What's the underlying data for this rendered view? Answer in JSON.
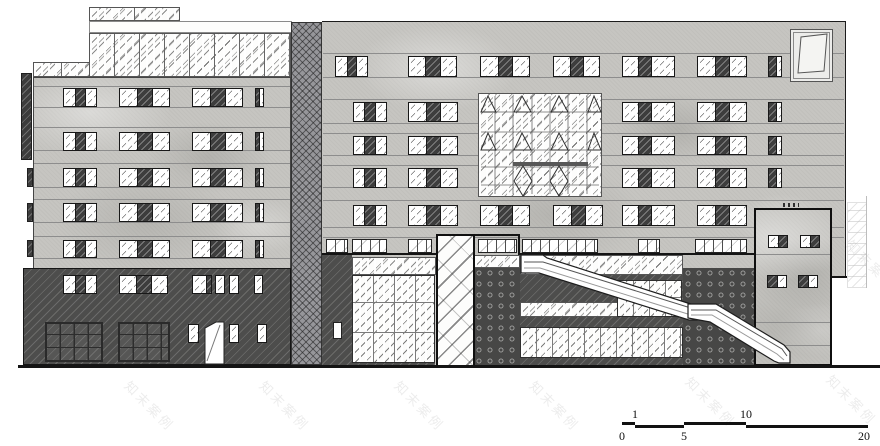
{
  "watermark": {
    "text": "知末案例",
    "positions": [
      [
        118,
        396
      ],
      [
        253,
        396
      ],
      [
        388,
        396
      ],
      [
        523,
        396
      ],
      [
        679,
        392
      ],
      [
        820,
        390
      ],
      [
        115,
        258
      ],
      [
        385,
        258
      ],
      [
        655,
        258
      ],
      [
        840,
        255
      ],
      [
        180,
        122
      ],
      [
        450,
        122
      ],
      [
        720,
        122
      ]
    ]
  },
  "scale_bar": {
    "unit_values": [
      "0",
      "1",
      "5",
      "10",
      "20"
    ],
    "segments": [
      {
        "x": 622,
        "y": 422,
        "w": 13
      },
      {
        "x": 635,
        "y": 425,
        "w": 49
      },
      {
        "x": 684,
        "y": 422,
        "w": 62
      },
      {
        "x": 746,
        "y": 425,
        "w": 122
      }
    ],
    "ticks_above": [
      {
        "label": "1",
        "x": 635
      },
      {
        "label": "10",
        "x": 746
      }
    ],
    "ticks_below": [
      {
        "label": "0",
        "x": 622
      },
      {
        "label": "5",
        "x": 684
      },
      {
        "label": "20",
        "x": 864
      }
    ]
  },
  "drawing": {
    "rects": [
      {
        "n": "left-side-fin",
        "c": "darkfin",
        "x": 21,
        "y": 73,
        "w": 11,
        "h": 87
      },
      {
        "n": "left-slab-tab-1",
        "c": "darkfin",
        "x": 27,
        "y": 168,
        "w": 6,
        "h": 19
      },
      {
        "n": "left-slab-tab-2",
        "c": "darkfin",
        "x": 27,
        "y": 203,
        "w": 6,
        "h": 19
      },
      {
        "n": "left-slab-tab-3",
        "c": "darkfin",
        "x": 27,
        "y": 240,
        "w": 6,
        "h": 17
      },
      {
        "n": "roof-glass-strip",
        "c": "glassband",
        "x": 89,
        "y": 7,
        "w": 91,
        "h": 14,
        "v": {
          "--mull": "45px"
        }
      },
      {
        "n": "roof-white-band",
        "c": "plainband",
        "x": 89,
        "y": 21,
        "w": 203,
        "h": 12
      },
      {
        "n": "upper-glass-band",
        "c": "glassband",
        "x": 89,
        "y": 33,
        "w": 202,
        "h": 44,
        "v": {
          "--mull": "25px"
        }
      },
      {
        "n": "upper-glass-band-left",
        "c": "glassband",
        "x": 33,
        "y": 62,
        "w": 57,
        "h": 15,
        "v": {
          "--mull": "28px"
        }
      },
      {
        "n": "left-facade",
        "c": "concrete edge-all-lt",
        "x": 33,
        "y": 77,
        "w": 258,
        "h": 191
      },
      {
        "n": "floor-line",
        "c": "hline",
        "x": 34,
        "y": 86,
        "w": 256,
        "h": 1
      },
      {
        "n": "floor-line",
        "c": "hline",
        "x": 34,
        "y": 107,
        "w": 256,
        "h": 1
      },
      {
        "n": "floor-line",
        "c": "hline",
        "x": 34,
        "y": 127,
        "w": 256,
        "h": 1
      },
      {
        "n": "floor-line",
        "c": "hline",
        "x": 34,
        "y": 150,
        "w": 256,
        "h": 1
      },
      {
        "n": "floor-line",
        "c": "hline",
        "x": 34,
        "y": 163,
        "w": 256,
        "h": 1
      },
      {
        "n": "floor-line",
        "c": "hline",
        "x": 34,
        "y": 187,
        "w": 256,
        "h": 1
      },
      {
        "n": "floor-line",
        "c": "hline",
        "x": 34,
        "y": 199,
        "w": 256,
        "h": 1
      },
      {
        "n": "floor-line",
        "c": "hline",
        "x": 34,
        "y": 222,
        "w": 256,
        "h": 1
      },
      {
        "n": "floor-line",
        "c": "hline",
        "x": 34,
        "y": 236,
        "w": 256,
        "h": 1
      },
      {
        "n": "floor-line",
        "c": "hline",
        "x": 34,
        "y": 258,
        "w": 256,
        "h": 1
      },
      {
        "n": "left-base-wall",
        "c": "darkwall edge-dark",
        "x": 23,
        "y": 268,
        "w": 268,
        "h": 97
      },
      {
        "n": "storefront-grid-1",
        "c": "storefront",
        "x": 45,
        "y": 322,
        "w": 58,
        "h": 40
      },
      {
        "n": "storefront-grid-2",
        "c": "storefront",
        "x": 118,
        "y": 322,
        "w": 52,
        "h": 40
      },
      {
        "n": "link-tower",
        "c": "crosshatch",
        "x": 291,
        "y": 22,
        "w": 31,
        "h": 343
      },
      {
        "n": "right-facade-upper",
        "c": "concrete edge-top edge-right",
        "x": 322,
        "y": 21,
        "w": 524,
        "h": 256
      },
      {
        "n": "right-facade-lower",
        "c": "concrete",
        "x": 322,
        "y": 277,
        "w": 510,
        "h": 88
      },
      {
        "n": "floor-line",
        "c": "hline",
        "x": 323,
        "y": 53,
        "w": 521,
        "h": 1
      },
      {
        "n": "floor-line",
        "c": "hline",
        "x": 323,
        "y": 77,
        "w": 521,
        "h": 1
      },
      {
        "n": "floor-line",
        "c": "hline",
        "x": 323,
        "y": 99,
        "w": 521,
        "h": 1
      },
      {
        "n": "floor-line",
        "c": "hline",
        "x": 323,
        "y": 123,
        "w": 521,
        "h": 1
      },
      {
        "n": "floor-line",
        "c": "hline",
        "x": 323,
        "y": 133,
        "w": 521,
        "h": 1
      },
      {
        "n": "floor-line",
        "c": "hline",
        "x": 323,
        "y": 155,
        "w": 521,
        "h": 1
      },
      {
        "n": "floor-line",
        "c": "hline",
        "x": 323,
        "y": 165,
        "w": 521,
        "h": 1
      },
      {
        "n": "floor-line",
        "c": "hline",
        "x": 323,
        "y": 187,
        "w": 521,
        "h": 1
      },
      {
        "n": "floor-line",
        "c": "hline",
        "x": 323,
        "y": 200,
        "w": 521,
        "h": 1
      },
      {
        "n": "floor-line",
        "c": "hline",
        "x": 323,
        "y": 227,
        "w": 521,
        "h": 1
      },
      {
        "n": "floor-line",
        "c": "hline",
        "x": 323,
        "y": 237,
        "w": 521,
        "h": 1
      },
      {
        "n": "right-step-line",
        "c": "solidblack",
        "x": 830,
        "y": 276,
        "w": 17,
        "h": 2
      },
      {
        "n": "groundfloor-outline-left",
        "c": "solidblack",
        "x": 322,
        "y": 253,
        "w": 114,
        "h": 2
      },
      {
        "n": "groundfloor-outline-raised",
        "c": "solidblack",
        "x": 436,
        "y": 234,
        "w": 84,
        "h": 2
      },
      {
        "n": "groundfloor-outline-raised-drop",
        "c": "solidblack",
        "x": 518,
        "y": 236,
        "w": 2,
        "h": 19
      },
      {
        "n": "groundfloor-outline-right",
        "c": "solidblack",
        "x": 520,
        "y": 253,
        "w": 238,
        "h": 2
      },
      {
        "n": "clerestory-window",
        "c": "clerestory",
        "x": 326,
        "y": 239,
        "w": 22,
        "h": 14
      },
      {
        "n": "clerestory-window",
        "c": "clerestory",
        "x": 352,
        "y": 239,
        "w": 35,
        "h": 14
      },
      {
        "n": "clerestory-window",
        "c": "clerestory",
        "x": 408,
        "y": 239,
        "w": 24,
        "h": 14
      },
      {
        "n": "clerestory-window",
        "c": "clerestory",
        "x": 478,
        "y": 239,
        "w": 39,
        "h": 14
      },
      {
        "n": "clerestory-window",
        "c": "clerestory",
        "x": 522,
        "y": 239,
        "w": 76,
        "h": 14
      },
      {
        "n": "clerestory-window",
        "c": "clerestory",
        "x": 638,
        "y": 239,
        "w": 22,
        "h": 14
      },
      {
        "n": "clerestory-window",
        "c": "clerestory",
        "x": 695,
        "y": 239,
        "w": 52,
        "h": 14
      },
      {
        "n": "gf-wall-left",
        "c": "darkwall",
        "x": 322,
        "y": 255,
        "w": 30,
        "h": 110
      },
      {
        "n": "gf-small-door",
        "c": "whitedoor",
        "x": 333,
        "y": 322,
        "w": 9,
        "h": 17
      },
      {
        "n": "gf-light-band-1",
        "c": "glassband",
        "x": 352,
        "y": 257,
        "w": 84,
        "h": 18,
        "v": {
          "--mull": "90px"
        }
      },
      {
        "n": "gf-big-glazing",
        "c": "glazing",
        "x": 352,
        "y": 275,
        "w": 83,
        "h": 88,
        "v": {
          "--gx": "21px",
          "--gy": "30px"
        }
      },
      {
        "n": "gf-under-strip-1",
        "c": "darkwall",
        "x": 352,
        "y": 363,
        "w": 83,
        "h": 2
      },
      {
        "n": "gf-light-band-1b",
        "c": "glassband",
        "x": 474,
        "y": 255,
        "w": 46,
        "h": 13,
        "v": {
          "--mull": "95px"
        }
      },
      {
        "n": "gf-dot-panel-1",
        "c": "dotted",
        "x": 474,
        "y": 268,
        "w": 46,
        "h": 97
      },
      {
        "n": "gf-light-band-2",
        "c": "glassband",
        "x": 520,
        "y": 255,
        "w": 163,
        "h": 20,
        "v": {
          "--mull": "180px"
        }
      },
      {
        "n": "gf-dark-band-1",
        "c": "darkwall",
        "x": 520,
        "y": 275,
        "w": 163,
        "h": 27
      },
      {
        "n": "gf-light-band-3",
        "c": "glassband",
        "x": 520,
        "y": 302,
        "w": 163,
        "h": 15,
        "v": {
          "--mull": "180px"
        }
      },
      {
        "n": "gf-dark-band-2",
        "c": "darkwall",
        "x": 520,
        "y": 317,
        "w": 163,
        "h": 10
      },
      {
        "n": "gf-glazing-row",
        "c": "glazing",
        "x": 520,
        "y": 327,
        "w": 163,
        "h": 31,
        "v": {
          "--gx": "16px",
          "--gy": "31px"
        }
      },
      {
        "n": "gf-under-strip-2",
        "c": "darkwall",
        "x": 520,
        "y": 358,
        "w": 163,
        "h": 7
      },
      {
        "n": "gf-glass-block",
        "c": "glazing",
        "x": 617,
        "y": 280,
        "w": 65,
        "h": 37,
        "v": {
          "--gx": "16px",
          "--gy": "19px"
        }
      },
      {
        "n": "gf-dot-panel-2",
        "c": "dotted",
        "x": 683,
        "y": 268,
        "w": 72,
        "h": 97
      },
      {
        "n": "gf-glass-tower",
        "c": "towerglass",
        "x": 436,
        "y": 234,
        "w": 39,
        "h": 131
      },
      {
        "n": "right-annex-faint",
        "c": "annex",
        "x": 847,
        "y": 202,
        "w": 20,
        "h": 86
      },
      {
        "n": "right-annex-line",
        "c": "vline",
        "x": 866,
        "y": 196,
        "w": 1,
        "h": 92
      },
      {
        "n": "entry-box",
        "c": "concrete box-border",
        "x": 754,
        "y": 208,
        "w": 78,
        "h": 158
      },
      {
        "n": "box-floor-line",
        "c": "hline",
        "x": 756,
        "y": 254,
        "w": 74,
        "h": 1
      },
      {
        "n": "box-floor-line",
        "c": "hline",
        "x": 756,
        "y": 322,
        "w": 74,
        "h": 1
      },
      {
        "n": "box-floor-line",
        "c": "hline",
        "x": 756,
        "y": 345,
        "w": 74,
        "h": 1
      },
      {
        "n": "box-vent-ticks",
        "c": "ticks",
        "x": 783,
        "y": 203,
        "w": 16,
        "h": 4
      },
      {
        "n": "roof-detail-panel",
        "c": "detailpanel",
        "x": 790,
        "y": 29,
        "w": 43,
        "h": 53
      },
      {
        "n": "curtainwall-feature-frame",
        "c": "glassband",
        "x": 478,
        "y": 93,
        "w": 124,
        "h": 104,
        "v": {
          "--mull": "300px"
        }
      },
      {
        "n": "ground-line",
        "c": "solidblack",
        "x": 18,
        "y": 365,
        "w": 862,
        "h": 3
      }
    ],
    "windows": [
      {
        "x": 63,
        "y": 88,
        "w": 34,
        "h": 19,
        "p": "g,d,g"
      },
      {
        "x": 119,
        "y": 88,
        "w": 51,
        "h": 19,
        "p": "g,d,g"
      },
      {
        "x": 192,
        "y": 88,
        "w": 51,
        "h": 19,
        "p": "g,d,g"
      },
      {
        "x": 255,
        "y": 88,
        "w": 9,
        "h": 19,
        "p": "d45,g55"
      },
      {
        "x": 63,
        "y": 132,
        "w": 34,
        "h": 19,
        "p": "g,d,g"
      },
      {
        "x": 119,
        "y": 132,
        "w": 51,
        "h": 19,
        "p": "g,d,g"
      },
      {
        "x": 192,
        "y": 132,
        "w": 51,
        "h": 19,
        "p": "g,d,g"
      },
      {
        "x": 255,
        "y": 132,
        "w": 9,
        "h": 19,
        "p": "d45,g55"
      },
      {
        "x": 63,
        "y": 168,
        "w": 34,
        "h": 19,
        "p": "g,d,g"
      },
      {
        "x": 119,
        "y": 168,
        "w": 51,
        "h": 19,
        "p": "g,d,g"
      },
      {
        "x": 192,
        "y": 168,
        "w": 51,
        "h": 19,
        "p": "g,d,g"
      },
      {
        "x": 255,
        "y": 168,
        "w": 9,
        "h": 19,
        "p": "d45,g55"
      },
      {
        "x": 63,
        "y": 203,
        "w": 34,
        "h": 19,
        "p": "g,d,g"
      },
      {
        "x": 119,
        "y": 203,
        "w": 51,
        "h": 19,
        "p": "g,d,g"
      },
      {
        "x": 192,
        "y": 203,
        "w": 51,
        "h": 19,
        "p": "g,d,g"
      },
      {
        "x": 255,
        "y": 203,
        "w": 9,
        "h": 19,
        "p": "d45,g55"
      },
      {
        "x": 63,
        "y": 240,
        "w": 34,
        "h": 18,
        "p": "g,d,g"
      },
      {
        "x": 119,
        "y": 240,
        "w": 51,
        "h": 18,
        "p": "g,d,g"
      },
      {
        "x": 192,
        "y": 240,
        "w": 51,
        "h": 18,
        "p": "g,d,g"
      },
      {
        "x": 255,
        "y": 240,
        "w": 9,
        "h": 18,
        "p": "d45,g55"
      },
      {
        "x": 63,
        "y": 275,
        "w": 34,
        "h": 19,
        "p": "g,d,g"
      },
      {
        "x": 119,
        "y": 275,
        "w": 49,
        "h": 19,
        "p": "g,d,g"
      },
      {
        "x": 192,
        "y": 275,
        "w": 20,
        "h": 19,
        "p": "g70,d30"
      },
      {
        "x": 215,
        "y": 275,
        "w": 10,
        "h": 19,
        "p": "g"
      },
      {
        "x": 229,
        "y": 275,
        "w": 10,
        "h": 19,
        "p": "g"
      },
      {
        "x": 254,
        "y": 275,
        "w": 9,
        "h": 19,
        "p": "g"
      },
      {
        "x": 188,
        "y": 324,
        "w": 11,
        "h": 19,
        "p": "g"
      },
      {
        "x": 229,
        "y": 324,
        "w": 10,
        "h": 19,
        "p": "g"
      },
      {
        "x": 257,
        "y": 324,
        "w": 10,
        "h": 19,
        "p": "g"
      },
      {
        "x": 335,
        "y": 56,
        "w": 33,
        "h": 21,
        "p": "g,d,g"
      },
      {
        "x": 408,
        "y": 56,
        "w": 49,
        "h": 21,
        "p": "g,d,g"
      },
      {
        "x": 480,
        "y": 56,
        "w": 50,
        "h": 21,
        "p": "g,d,g"
      },
      {
        "x": 553,
        "y": 56,
        "w": 47,
        "h": 21,
        "p": "g,d,g"
      },
      {
        "x": 622,
        "y": 56,
        "w": 53,
        "h": 21,
        "p": "g30,d25,g45"
      },
      {
        "x": 697,
        "y": 56,
        "w": 50,
        "h": 21,
        "p": "g,d,g"
      },
      {
        "x": 768,
        "y": 56,
        "w": 14,
        "h": 21,
        "p": "d60,g40"
      },
      {
        "x": 353,
        "y": 102,
        "w": 34,
        "h": 20,
        "p": "g30,d35,g35"
      },
      {
        "x": 408,
        "y": 102,
        "w": 50,
        "h": 20,
        "p": "g,d,g"
      },
      {
        "x": 622,
        "y": 102,
        "w": 53,
        "h": 20,
        "p": "g30,d25,g45"
      },
      {
        "x": 697,
        "y": 102,
        "w": 50,
        "h": 20,
        "p": "g,d,g"
      },
      {
        "x": 768,
        "y": 102,
        "w": 14,
        "h": 20,
        "p": "d60,g40"
      },
      {
        "x": 353,
        "y": 136,
        "w": 34,
        "h": 19,
        "p": "g30,d35,g35"
      },
      {
        "x": 408,
        "y": 136,
        "w": 50,
        "h": 19,
        "p": "g,d,g"
      },
      {
        "x": 622,
        "y": 136,
        "w": 53,
        "h": 19,
        "p": "g30,d25,g45"
      },
      {
        "x": 697,
        "y": 136,
        "w": 50,
        "h": 19,
        "p": "g,d,g"
      },
      {
        "x": 768,
        "y": 136,
        "w": 14,
        "h": 19,
        "p": "d60,g40"
      },
      {
        "x": 353,
        "y": 168,
        "w": 34,
        "h": 20,
        "p": "g30,d35,g35"
      },
      {
        "x": 408,
        "y": 168,
        "w": 50,
        "h": 20,
        "p": "g,d,g"
      },
      {
        "x": 622,
        "y": 168,
        "w": 53,
        "h": 20,
        "p": "g30,d25,g45"
      },
      {
        "x": 697,
        "y": 168,
        "w": 50,
        "h": 20,
        "p": "g,d,g"
      },
      {
        "x": 768,
        "y": 168,
        "w": 14,
        "h": 20,
        "p": "d60,g40"
      },
      {
        "x": 353,
        "y": 205,
        "w": 34,
        "h": 21,
        "p": "g30,d35,g35"
      },
      {
        "x": 408,
        "y": 205,
        "w": 50,
        "h": 21,
        "p": "g,d,g"
      },
      {
        "x": 480,
        "y": 205,
        "w": 50,
        "h": 21,
        "p": "g,d,g"
      },
      {
        "x": 553,
        "y": 205,
        "w": 50,
        "h": 21,
        "p": "g,d,g"
      },
      {
        "x": 622,
        "y": 205,
        "w": 53,
        "h": 21,
        "p": "g30,d25,g45"
      },
      {
        "x": 697,
        "y": 205,
        "w": 50,
        "h": 21,
        "p": "g,d,g"
      },
      {
        "x": 768,
        "y": 235,
        "w": 20,
        "h": 13,
        "p": "g,d"
      },
      {
        "x": 800,
        "y": 235,
        "w": 20,
        "h": 13,
        "p": "g,d"
      },
      {
        "x": 767,
        "y": 275,
        "w": 20,
        "h": 13,
        "p": "d,g"
      },
      {
        "x": 798,
        "y": 275,
        "w": 20,
        "h": 13,
        "p": "d,g"
      }
    ]
  }
}
